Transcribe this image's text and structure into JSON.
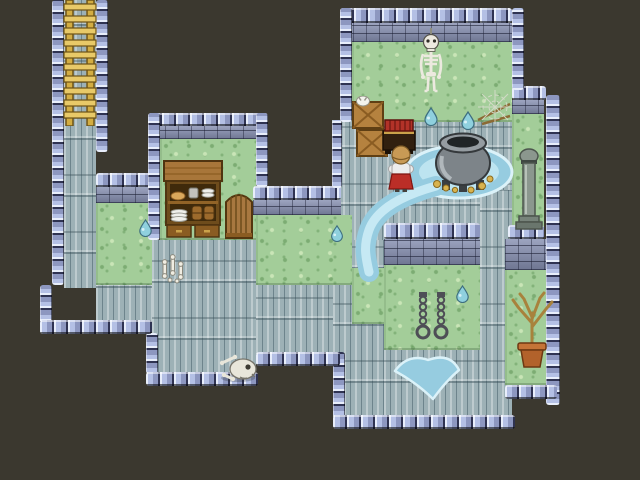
{
  "scene": {
    "title": "dungeon-interior-map",
    "width": 640,
    "height": 480,
    "background": "#3b382f"
  },
  "palette": {
    "void": "#3b382f",
    "floor": "#9db1b6",
    "grass": "#a3cd99",
    "wall_knob_light": "#e8eefb",
    "wall_knob_mid": "#b4c0e5",
    "wall_knob_dark": "#2f3352",
    "wall_face": "#8790b2",
    "water_outer": "#96cce0",
    "water_inner": "#c0e6f2",
    "ladder_gold": "#d3ad42",
    "wood": "#a8763a",
    "hero_skirt": "#bb2e27",
    "hero_shirt": "#ececec",
    "hero_hair": "#c89a55",
    "bone": "#ece9df",
    "cauldron_gray": "#7d8489",
    "gold": "#d9b34e",
    "terracotta": "#b2622b"
  },
  "map": {
    "tile_size": 32,
    "regions": [
      {
        "type": "floor",
        "x": 64,
        "y": 0,
        "w": 32,
        "h": 288
      },
      {
        "type": "floor",
        "x": 96,
        "y": 280,
        "w": 56,
        "h": 42
      },
      {
        "type": "floor",
        "x": 152,
        "y": 240,
        "w": 104,
        "h": 134
      },
      {
        "type": "floor",
        "x": 256,
        "y": 285,
        "w": 77,
        "h": 69
      },
      {
        "type": "floor",
        "x": 332,
        "y": 120,
        "w": 180,
        "h": 120
      },
      {
        "type": "floor",
        "x": 333,
        "y": 240,
        "w": 51,
        "h": 177
      },
      {
        "type": "floor",
        "x": 384,
        "y": 350,
        "w": 96,
        "h": 67
      },
      {
        "type": "floor",
        "x": 480,
        "y": 190,
        "w": 32,
        "h": 227
      },
      {
        "type": "grass",
        "x": 352,
        "y": 40,
        "w": 160,
        "h": 82
      },
      {
        "type": "grass",
        "x": 512,
        "y": 114,
        "w": 32,
        "h": 118
      },
      {
        "type": "grass",
        "x": 160,
        "y": 139,
        "w": 96,
        "h": 101
      },
      {
        "type": "grass",
        "x": 96,
        "y": 203,
        "w": 56,
        "h": 82
      },
      {
        "type": "grass",
        "x": 256,
        "y": 215,
        "w": 96,
        "h": 70
      },
      {
        "type": "grass",
        "x": 352,
        "y": 268,
        "w": 32,
        "h": 56
      },
      {
        "type": "grass",
        "x": 384,
        "y": 265,
        "w": 96,
        "h": 85
      },
      {
        "type": "grass",
        "x": 505,
        "y": 270,
        "w": 50,
        "h": 115
      },
      {
        "type": "walltop",
        "x": 340,
        "y": 8,
        "w": 172,
        "h": 15
      },
      {
        "type": "wallface",
        "x": 340,
        "y": 23,
        "w": 172,
        "h": 19
      },
      {
        "type": "walltop",
        "x": 148,
        "y": 113,
        "w": 120,
        "h": 13
      },
      {
        "type": "wallface",
        "x": 152,
        "y": 126,
        "w": 104,
        "h": 13
      },
      {
        "type": "walltop",
        "x": 96,
        "y": 173,
        "w": 64,
        "h": 14
      },
      {
        "type": "wallface",
        "x": 96,
        "y": 187,
        "w": 64,
        "h": 16
      },
      {
        "type": "walltop",
        "x": 253,
        "y": 186,
        "w": 88,
        "h": 14
      },
      {
        "type": "wallface",
        "x": 253,
        "y": 200,
        "w": 88,
        "h": 15
      },
      {
        "type": "walltop",
        "x": 384,
        "y": 223,
        "w": 96,
        "h": 16
      },
      {
        "type": "wallface",
        "x": 384,
        "y": 239,
        "w": 96,
        "h": 26
      },
      {
        "type": "walltop",
        "x": 512,
        "y": 86,
        "w": 34,
        "h": 14
      },
      {
        "type": "wallface",
        "x": 512,
        "y": 100,
        "w": 32,
        "h": 14
      },
      {
        "type": "walltop",
        "x": 508,
        "y": 225,
        "w": 36,
        "h": 14
      },
      {
        "type": "wallface",
        "x": 505,
        "y": 239,
        "w": 53,
        "h": 31
      },
      {
        "type": "edgev",
        "x": 52,
        "y": 0,
        "w": 12,
        "h": 285
      },
      {
        "type": "edgev",
        "x": 40,
        "y": 285,
        "w": 12,
        "h": 49
      },
      {
        "type": "edgev",
        "x": 96,
        "y": 0,
        "w": 12,
        "h": 152
      },
      {
        "type": "edgev",
        "x": 148,
        "y": 113,
        "w": 12,
        "h": 127
      },
      {
        "type": "edgev",
        "x": 256,
        "y": 113,
        "w": 12,
        "h": 74
      },
      {
        "type": "edgev",
        "x": 340,
        "y": 8,
        "w": 12,
        "h": 114
      },
      {
        "type": "edgev",
        "x": 512,
        "y": 8,
        "w": 12,
        "h": 82
      },
      {
        "type": "edgev",
        "x": 332,
        "y": 120,
        "w": 10,
        "h": 68
      },
      {
        "type": "edgev",
        "x": 546,
        "y": 95,
        "w": 14,
        "h": 310
      },
      {
        "type": "edgev",
        "x": 146,
        "y": 333,
        "w": 12,
        "h": 41
      },
      {
        "type": "edgev",
        "x": 333,
        "y": 352,
        "w": 12,
        "h": 65
      },
      {
        "type": "edgeh",
        "x": 40,
        "y": 320,
        "w": 112,
        "h": 14
      },
      {
        "type": "edgeh",
        "x": 146,
        "y": 372,
        "w": 112,
        "h": 14
      },
      {
        "type": "edgeh",
        "x": 256,
        "y": 352,
        "w": 84,
        "h": 14
      },
      {
        "type": "edgeh",
        "x": 333,
        "y": 415,
        "w": 182,
        "h": 14
      },
      {
        "type": "edgeh",
        "x": 505,
        "y": 385,
        "w": 52,
        "h": 14
      }
    ]
  },
  "water": {
    "cauldron_pool": {
      "attrs": {
        "cx": "459",
        "cy": "172",
        "rx": "53",
        "ry": "26",
        "fill": "#96cce0",
        "stroke": "#dbf2f9",
        "stroke-width": "3"
      }
    },
    "cauldron_pool_inner": {
      "attrs": {
        "cx": "459",
        "cy": "172",
        "rx": "40",
        "ry": "18",
        "fill": "#bde4f0"
      }
    },
    "stream_outer": {
      "attrs": {
        "d": "M436 186 C400 196 376 210 369 230 C363 247 366 258 369 272",
        "stroke": "#96cce0",
        "stroke-width": "20",
        "fill": "none",
        "stroke-linecap": "round"
      }
    },
    "stream_inner": {
      "attrs": {
        "d": "M436 186 C400 196 376 210 369 230 C363 247 366 258 369 272",
        "stroke": "#c6e9f4",
        "stroke-width": "9",
        "fill": "none",
        "stroke-linecap": "round"
      }
    },
    "bottom_pool": {
      "attrs": {
        "d": "M395 371 Q408 353 428 360 Q450 352 459 370 Q446 381 433 399 Q417 383 395 371 Z",
        "fill": "#96cce0",
        "stroke": "#dbf2f9",
        "stroke-width": "2.5",
        "stroke-linejoin": "round"
      }
    }
  },
  "sprites": {
    "ladder": {
      "x": 58,
      "y": 0,
      "w": 44,
      "h": 126,
      "label": "exit ladder"
    },
    "skeleton": {
      "x": 412,
      "y": 28,
      "w": 38,
      "h": 72,
      "label": "hanging skeleton"
    },
    "crates": {
      "x": 352,
      "y": 96,
      "w": 36,
      "h": 62,
      "label": "wooden crates with white critter"
    },
    "book_table": {
      "x": 382,
      "y": 118,
      "w": 34,
      "h": 36,
      "label": "stand with red books"
    },
    "hero": {
      "x": 388,
      "y": 144,
      "w": 26,
      "h": 48,
      "label": "player character facing up"
    },
    "cauldron": {
      "x": 430,
      "y": 126,
      "w": 66,
      "h": 68,
      "label": "large cauldron with gold at base"
    },
    "cobweb": {
      "x": 476,
      "y": 88,
      "w": 38,
      "h": 38,
      "label": "cobweb on sticks"
    },
    "pillar": {
      "x": 514,
      "y": 148,
      "w": 30,
      "h": 82,
      "label": "stone column"
    },
    "shelf": {
      "x": 163,
      "y": 160,
      "w": 60,
      "h": 79,
      "label": "cupboard with dishes and barrels"
    },
    "gate": {
      "x": 225,
      "y": 190,
      "w": 28,
      "h": 49,
      "label": "wooden gate"
    },
    "bone_critter": {
      "x": 158,
      "y": 253,
      "w": 30,
      "h": 32,
      "label": "small bones"
    },
    "skull_pile": {
      "x": 218,
      "y": 348,
      "w": 40,
      "h": 36,
      "label": "skull and bones pile"
    },
    "chains": {
      "x": 414,
      "y": 292,
      "w": 36,
      "h": 50,
      "label": "wall shackles"
    },
    "potted_tree": {
      "x": 506,
      "y": 291,
      "w": 52,
      "h": 80,
      "label": "dead potted tree"
    },
    "droplet_post_1": {
      "x": 423,
      "y": 106,
      "w": 16,
      "h": 20,
      "label": "water droplet"
    },
    "droplet_post_2": {
      "x": 460,
      "y": 110,
      "w": 16,
      "h": 20,
      "label": "water droplet"
    },
    "droplet_grass_left": {
      "x": 137,
      "y": 218,
      "w": 17,
      "h": 19,
      "label": "water droplet"
    },
    "droplet_grass_mid": {
      "x": 329,
      "y": 224,
      "w": 16,
      "h": 18,
      "label": "water droplet"
    },
    "droplet_grass_chains": {
      "x": 454,
      "y": 284,
      "w": 17,
      "h": 19,
      "label": "water droplet"
    }
  }
}
